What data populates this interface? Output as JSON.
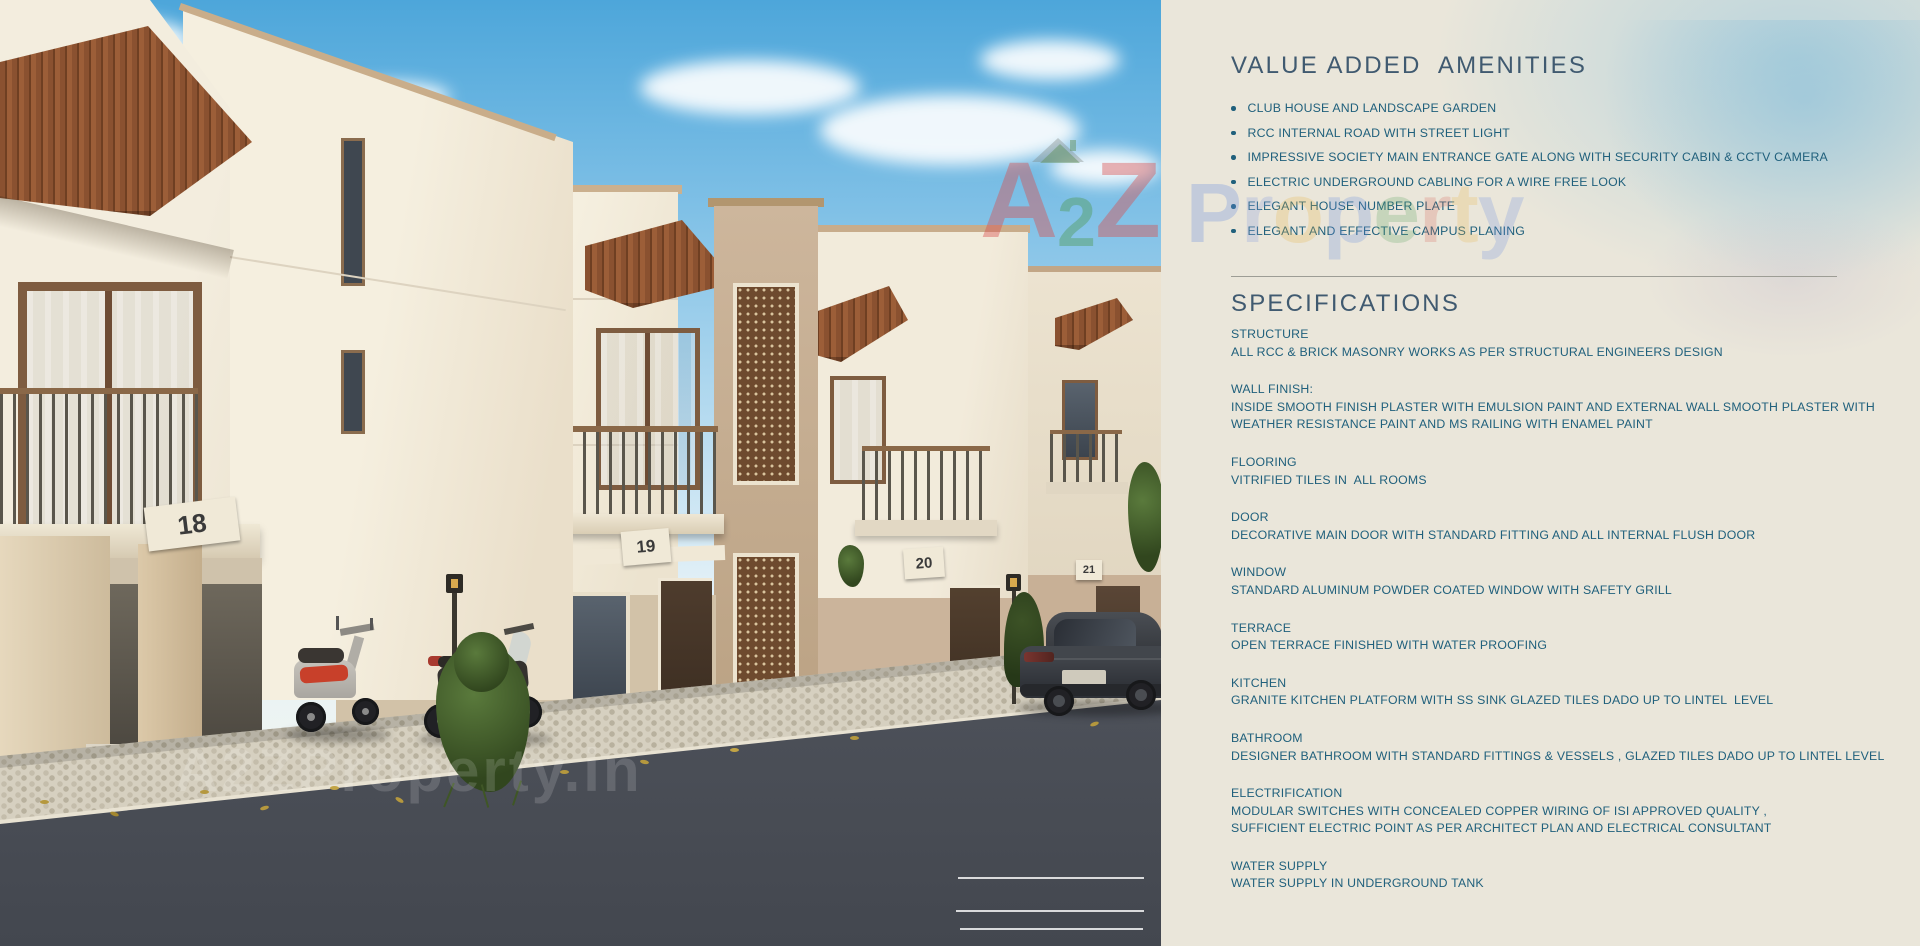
{
  "panel": {
    "amenities_title": "VALUE ADDED  AMENITIES",
    "amenities": [
      "CLUB HOUSE AND LANDSCAPE GARDEN",
      "RCC INTERNAL ROAD WITH STREET LIGHT",
      "IMPRESSIVE SOCIETY MAIN ENTRANCE GATE ALONG WITH SECURITY CABIN & CCTV CAMERA",
      "ELECTRIC UNDERGROUND CABLING FOR A WIRE FREE LOOK",
      "ELEGANT HOUSE NUMBER PLATE",
      "ELEGANT AND EFFECTIVE CAMPUS PLANING"
    ],
    "specifications_title": "SPECIFICATIONS",
    "specifications": [
      {
        "label": "STRUCTURE",
        "lines": [
          "ALL RCC & BRICK MASONRY WORKS AS PER STRUCTURAL ENGINEERS DESIGN"
        ]
      },
      {
        "label": "WALL FINISH:",
        "lines": [
          "INSIDE SMOOTH FINISH PLASTER WITH EMULSION PAINT AND EXTERNAL WALL SMOOTH PLASTER WITH",
          "WEATHER RESISTANCE PAINT AND MS RAILING WITH ENAMEL PAINT"
        ]
      },
      {
        "label": "FLOORING",
        "lines": [
          "VITRIFIED TILES IN  ALL ROOMS"
        ]
      },
      {
        "label": "DOOR",
        "lines": [
          "DECORATIVE MAIN DOOR WITH STANDARD FITTING AND ALL INTERNAL FLUSH DOOR"
        ]
      },
      {
        "label": "WINDOW",
        "lines": [
          "STANDARD ALUMINUM POWDER COATED WINDOW WITH SAFETY GRILL"
        ]
      },
      {
        "label": "TERRACE",
        "lines": [
          "OPEN TERRACE FINISHED WITH WATER PROOFING"
        ]
      },
      {
        "label": "KITCHEN",
        "lines": [
          "GRANITE KITCHEN PLATFORM WITH SS SINK GLAZED TILES DADO UP TO LINTEL  LEVEL"
        ]
      },
      {
        "label": "BATHROOM",
        "lines": [
          "DESIGNER BATHROOM WITH STANDARD FITTINGS & VESSELS , GLAZED TILES DADO UP TO LINTEL LEVEL"
        ]
      },
      {
        "label": "ELECTRIFICATION",
        "lines": [
          "MODULAR SWITCHES WITH CONCEALED COPPER WIRING OF ISI APPROVED QUALITY ,",
          "SUFFICIENT ELECTRIC POINT AS PER ARCHITECT PLAN AND ELECTRICAL CONSULTANT"
        ]
      },
      {
        "label": "WATER SUPPLY",
        "lines": [
          "WATER SUPPLY IN UNDERGROUND TANK"
        ]
      }
    ],
    "colors": {
      "background": "#eae6da",
      "heading": "#405a70",
      "body": "#20607c",
      "divider": "#9d9d95"
    }
  },
  "photo": {
    "house_numbers": [
      "18",
      "19",
      "20",
      "21"
    ],
    "watermark_bottom": "A2ZProperty.in",
    "watermark_center": {
      "text": "A2Z Property",
      "letters": [
        {
          "ch": "A",
          "color": "#d94f4f",
          "size": 108,
          "opacity": 0.42
        },
        {
          "ch": "2",
          "color": "#4f9a55",
          "size": 70,
          "opacity": 0.42
        },
        {
          "ch": "Z",
          "color": "#d94f4f",
          "size": 108,
          "opacity": 0.42
        },
        {
          "ch": " ",
          "color": "#000000",
          "size": 40,
          "opacity": 0,
          "w": 26
        },
        {
          "ch": "P",
          "color": "#6a8fe0",
          "size": 84,
          "opacity": 0.3
        },
        {
          "ch": "r",
          "color": "#8aa0e0",
          "size": 84,
          "opacity": 0.28
        },
        {
          "ch": "o",
          "color": "#e8b54a",
          "size": 84,
          "opacity": 0.26
        },
        {
          "ch": "p",
          "color": "#6a8fe0",
          "size": 84,
          "opacity": 0.26
        },
        {
          "ch": "e",
          "color": "#57a35e",
          "size": 84,
          "opacity": 0.24
        },
        {
          "ch": "r",
          "color": "#d96a5a",
          "size": 84,
          "opacity": 0.24
        },
        {
          "ch": "t",
          "color": "#e8b54a",
          "size": 84,
          "opacity": 0.24
        },
        {
          "ch": "y",
          "color": "#6a8fe0",
          "size": 84,
          "opacity": 0.24
        }
      ]
    }
  }
}
